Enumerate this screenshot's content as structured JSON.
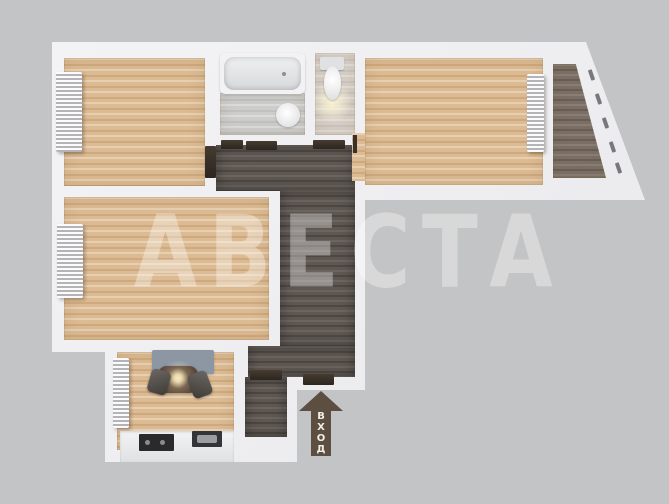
{
  "scene": {
    "description": "3D top-down render of an apartment floor plan on gray background",
    "watermark": {
      "text": "АВЕСТА"
    },
    "entrance_arrow": {
      "label": "ВХОД"
    }
  },
  "palette": {
    "background": "#c3c4c5",
    "wall": "#f2f2f4",
    "wood_floor": "#dcba92",
    "hallway_floor": "#5e5752",
    "balcony_floor": "#7b6f65",
    "bathroom_tile": "#cdcdcb",
    "wc_tile": "#d6cfc7",
    "rug": "#8d96a3",
    "arrow": "#5c4e40"
  },
  "rooms": [
    {
      "name": "bedroom-top-left",
      "floor": "wood",
      "fixtures": [
        "radiator"
      ]
    },
    {
      "name": "bedroom-middle-left",
      "floor": "wood",
      "fixtures": [
        "radiator"
      ]
    },
    {
      "name": "living-room",
      "floor": "wood",
      "fixtures": [
        "radiator"
      ]
    },
    {
      "name": "balcony",
      "floor": "dark-wood",
      "fixtures": [
        "windows-along-diagonal-wall"
      ]
    },
    {
      "name": "bathroom",
      "floor": "gray-tile",
      "fixtures": [
        "bathtub",
        "sink"
      ]
    },
    {
      "name": "wc",
      "floor": "beige-tile",
      "fixtures": [
        "toilet"
      ]
    },
    {
      "name": "hallway",
      "floor": "dark-wood",
      "fixtures": []
    },
    {
      "name": "entry-vestibule",
      "floor": "dark-wood",
      "fixtures": []
    },
    {
      "name": "kitchen",
      "floor": "wood",
      "fixtures": [
        "rug",
        "dining-table",
        "chair",
        "chair",
        "counter",
        "stove",
        "sink",
        "radiator"
      ]
    }
  ]
}
